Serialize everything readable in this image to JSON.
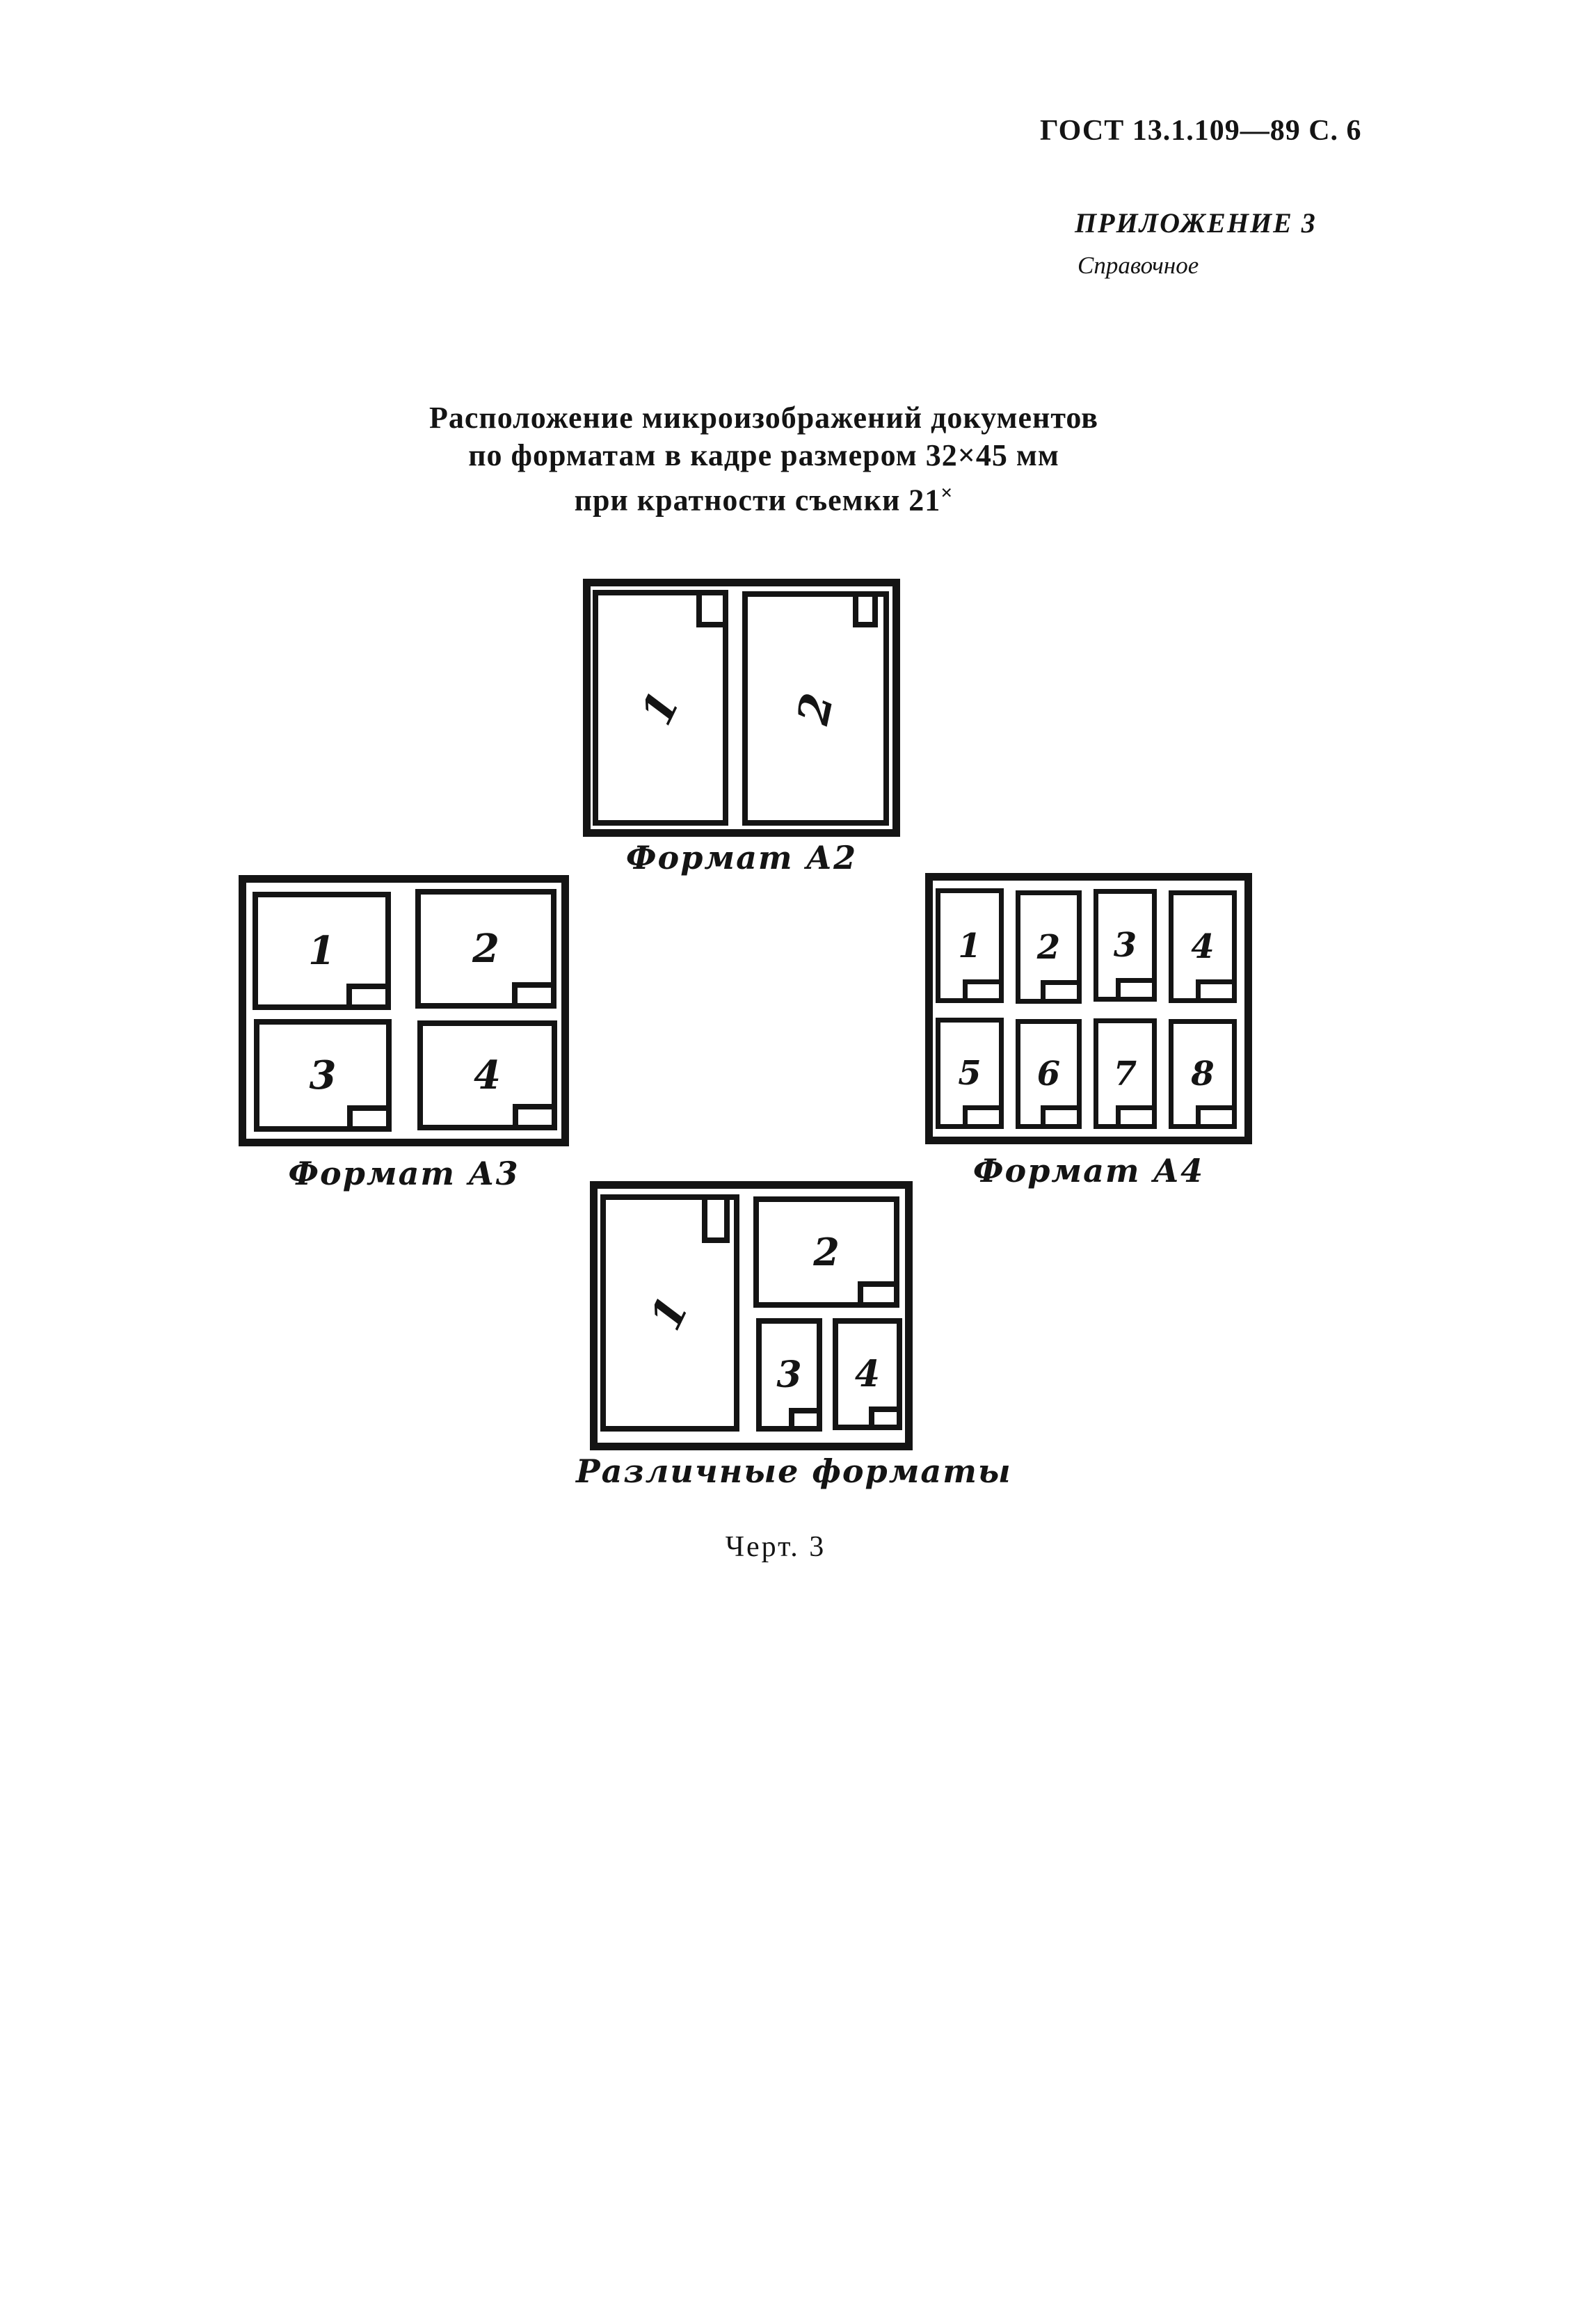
{
  "header": {
    "page_ref": "ГОСТ 13.1.109—89 С. 6"
  },
  "appendix": {
    "label": "ПРИЛОЖЕНИЕ 3",
    "type": "Справочное"
  },
  "title": {
    "line1": "Расположение микроизображений документов",
    "line2": "по форматам в кадре размером 32×45 мм",
    "line3_text": "при кратности съемки 21",
    "line3_sup": "×"
  },
  "diagrams": {
    "a2": {
      "caption": "Формат А2",
      "cells": [
        {
          "label": "1"
        },
        {
          "label": "2"
        }
      ]
    },
    "a3": {
      "caption": "Формат А3",
      "cells": [
        {
          "label": "1"
        },
        {
          "label": "2"
        },
        {
          "label": "3"
        },
        {
          "label": "4"
        }
      ]
    },
    "a4": {
      "caption": "Формат А4",
      "cells": [
        {
          "label": "1"
        },
        {
          "label": "2"
        },
        {
          "label": "3"
        },
        {
          "label": "4"
        },
        {
          "label": "5"
        },
        {
          "label": "6"
        },
        {
          "label": "7"
        },
        {
          "label": "8"
        }
      ]
    },
    "mixed": {
      "caption": "Различные форматы",
      "cells": [
        {
          "label": "1"
        },
        {
          "label": "2"
        },
        {
          "label": "3"
        },
        {
          "label": "4"
        }
      ]
    }
  },
  "figure": {
    "caption": "Черт. 3"
  }
}
